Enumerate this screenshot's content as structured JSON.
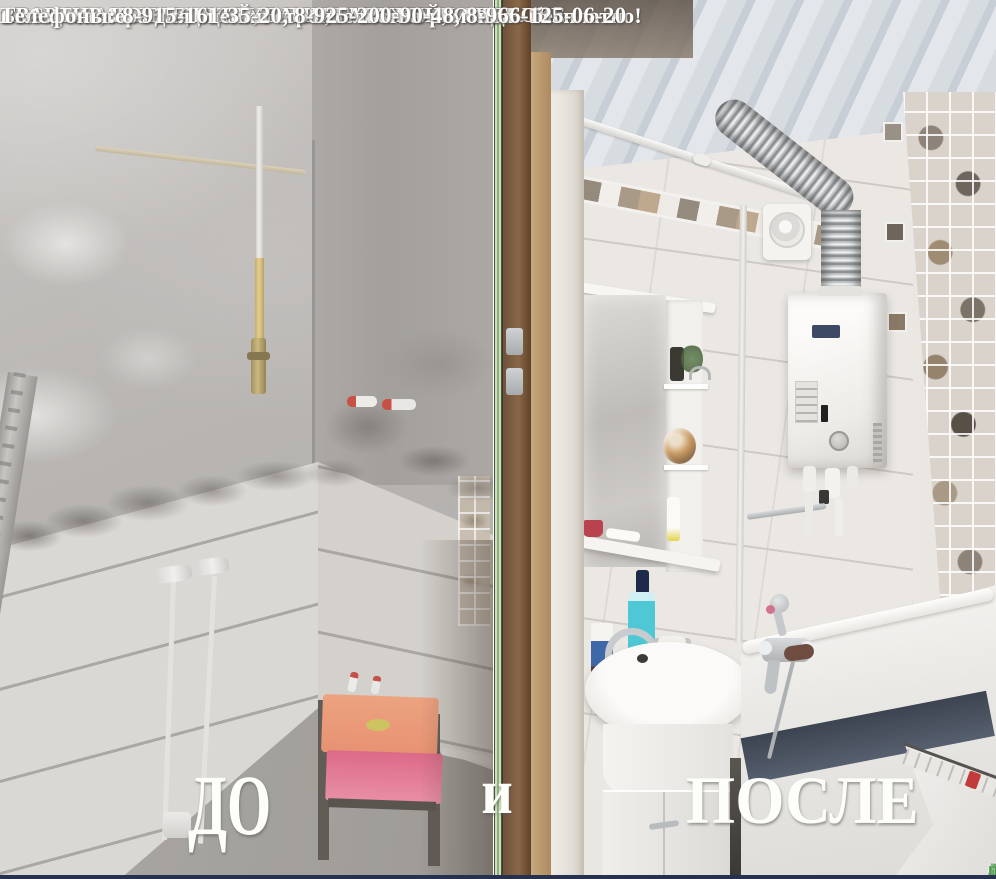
{
  "header": {
    "line1": "ВЕСЬ КОМПЛЕКС УСЛУГ ПО РЕМОНТУ И ОТДЕЛКЕ :",
    "line2": "КВАРТИР, КОТТЕДЖЕЙ, БАНЬ, ГАРАЖЕЙ, ОФИСОВ",
    "line3": "Выезд мастера для оценки строительства-ремонта - бесплатно!",
    "line4": "Телефоны: 8-915-161-35-20,  8-925-200-90-48, 8-966-125-06-20"
  },
  "compare": {
    "before_label": "ДО",
    "conjunction": "и",
    "after_label": "ПОСЛЕ"
  },
  "watermark": {
    "city": "ЛЫТКАРИНО",
    "suffix": "nline"
  },
  "colors": {
    "divider_green": "#8fae80",
    "text_white": "#ffffff",
    "watermark_gray": "#8c8c8c",
    "watermark_green": "#4f9a4f",
    "chair_back_orange": "#e8936f",
    "chair_seat_pink": "#e2708a",
    "gas_pipe_yellow": "#d9c178",
    "heater_badge_navy": "#3c4a66",
    "tub_gap_navy": "#2e3644",
    "bottom_border_navy": "#283050"
  }
}
